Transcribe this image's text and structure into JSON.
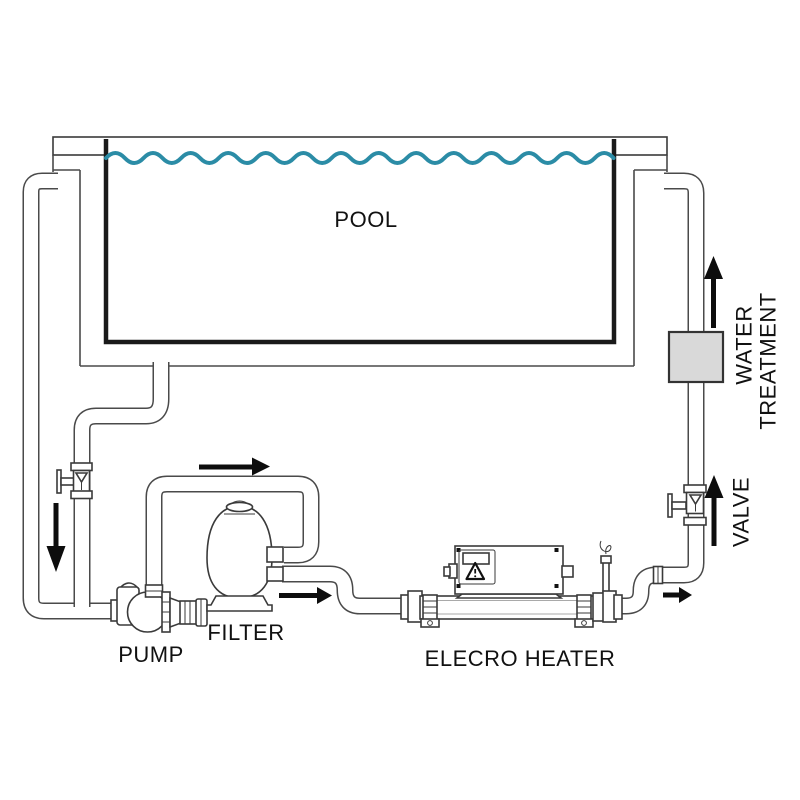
{
  "diagram": {
    "type": "piping-schematic",
    "title": "Pool heating system schematic",
    "labels": {
      "pool": "POOL",
      "pump": "PUMP",
      "filter": "FILTER",
      "heater": "ELECRO HEATER",
      "valve": "VALVE",
      "water_treatment_line1": "WATER",
      "water_treatment_line2": "TREATMENT"
    },
    "colors": {
      "background": "#ffffff",
      "water_line": "#2b8ca6",
      "pipe_outline": "#4a4a4a",
      "pool_basin_outline": "#1a1a1a",
      "text": "#111111",
      "arrow": "#0d0d0d",
      "treatment_box_fill": "#d9d9d9",
      "treatment_box_border": "#333333"
    },
    "components": [
      "pool",
      "skimmer-suction-pipe",
      "bottom-drain-pipe",
      "shutoff-valve-left",
      "pump",
      "sand-filter",
      "elecro-heater",
      "heater-control-box",
      "heater-warning-triangle",
      "temperature-probe",
      "return-valve",
      "water-treatment-unit",
      "return-riser-pipe"
    ],
    "flow_arrows": [
      {
        "id": "suction-drop",
        "direction": "down"
      },
      {
        "id": "pump-to-filter",
        "direction": "right"
      },
      {
        "id": "filter-to-heater",
        "direction": "right"
      },
      {
        "id": "heater-outlet",
        "direction": "right"
      },
      {
        "id": "valve-riser",
        "direction": "up"
      },
      {
        "id": "treatment-riser",
        "direction": "up"
      }
    ]
  }
}
